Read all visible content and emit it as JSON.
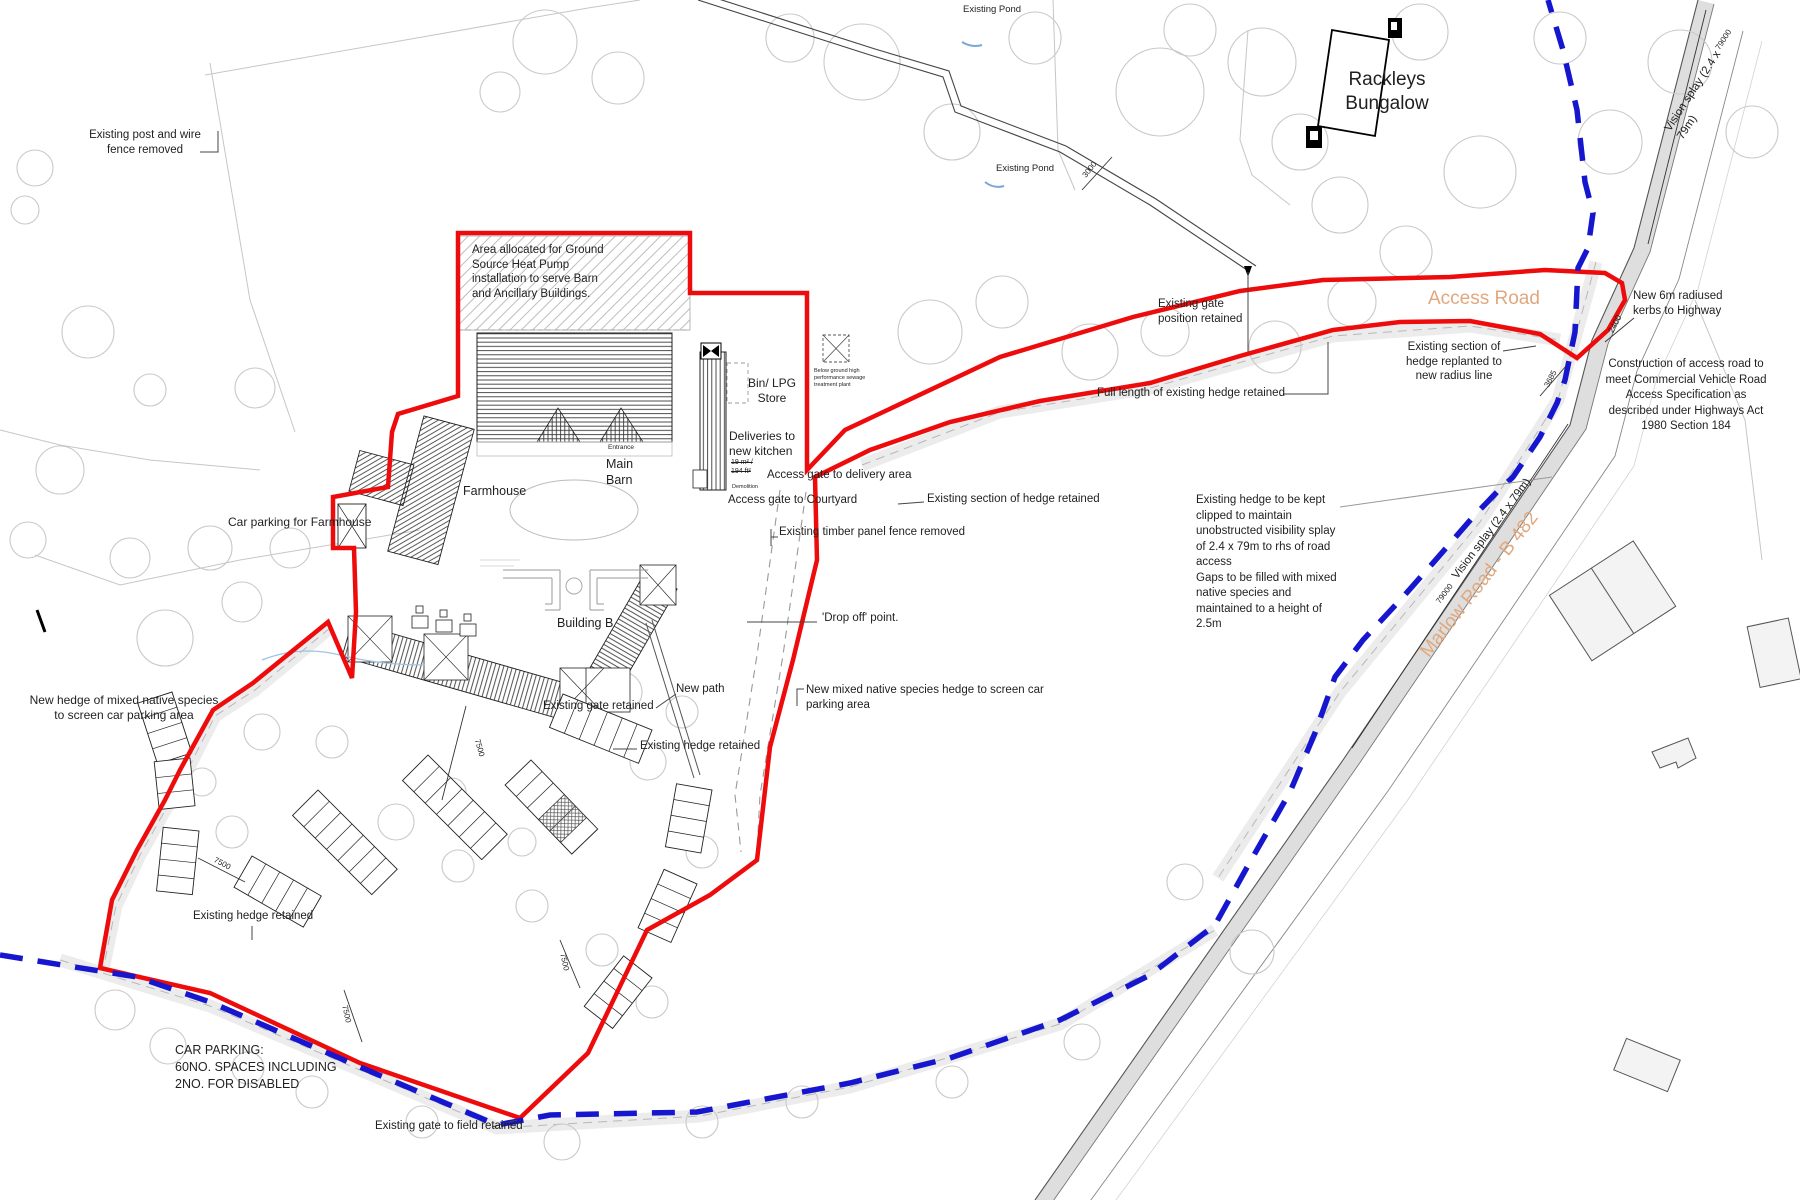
{
  "colors": {
    "boundary_red": "#ee0b0b",
    "splay_blue": "#1616cf",
    "road_label_tan": "#e0a87e",
    "road_fill": "#dedede",
    "survey_gray": "#c6c6c6",
    "text": "#1f1f1f"
  },
  "labels": {
    "post_wire_fence": "Existing post and wire\nfence removed",
    "pond_1": "Existing Pond",
    "pond_2": "Existing Pond",
    "rackleys_bungalow": "Rackleys\nBungalow",
    "gshp_area": "Area allocated for Ground\nSource Heat Pump\ninstallation to serve Barn\nand Ancillary Buildings.",
    "bin_lpg_store": "Bin/ LPG\nStore",
    "deliveries": "Deliveries to\nnew kitchen",
    "area_sqm": "19 m² /\n194 ft²",
    "demolition": "Demolition",
    "entrance": "Entrance",
    "main_barn": "Main\nBarn",
    "farmhouse": "Farmhouse",
    "car_parking_farmhouse": "Car parking for Farmhouse",
    "gate_delivery": "Access gate to delivery area",
    "gate_courtyard": "Access gate to Courtyard",
    "gate_position": "Existing gate\nposition retained",
    "access_road": "Access Road",
    "new_kerbs": "New 6m radiused\nkerbs to Highway",
    "hedge_replanted": "Existing section of\nhedge replanted to\nnew radius line",
    "full_length_hedge": "Full length of existing hedge retained",
    "construction_note": "Construction of access road to\nmeet Commercial Vehicle Road\nAccess Specification as\ndescribed under Highways Act\n1980 Section 184",
    "hedge_section_retained": "Existing section of hedge retained",
    "timber_fence": "Existing timber panel fence removed",
    "hedge_clipped_note": "Existing hedge to be kept\nclipped to maintain\nunobstructed visibility splay\nof 2.4 x 79m to rhs of road\naccess\nGaps to be filled with mixed\nnative species and\nmaintained to a height of\n2.5m",
    "building_b": "Building B",
    "drop_off": "'Drop off' point.",
    "new_path": "New path",
    "new_mixed_hedge": "New mixed native species hedge to screen car\nparking area",
    "gate_retained": "Existing gate retained",
    "hedge_retained_mid": "Existing hedge retained",
    "new_hedge_west": "New hedge of mixed native species\nto screen car parking area",
    "hedge_retained_low": "Existing hedge retained",
    "car_parking_note": "CAR PARKING:\n60NO. SPACES INCLUDING\n2NO. FOR DISABLED",
    "gate_field": "Existing gate to field retained",
    "marlow_road": "Marlow Road - B 482",
    "vision_splay": "Vision splay (2.4 x 79m)",
    "sewage_plant": "Below ground high\nperformance sewage\ntreatment plant"
  },
  "dims": {
    "d7500": "7500",
    "d2400": "2400",
    "d3685": "3685",
    "d3000": "3000",
    "d79000": "79000"
  }
}
